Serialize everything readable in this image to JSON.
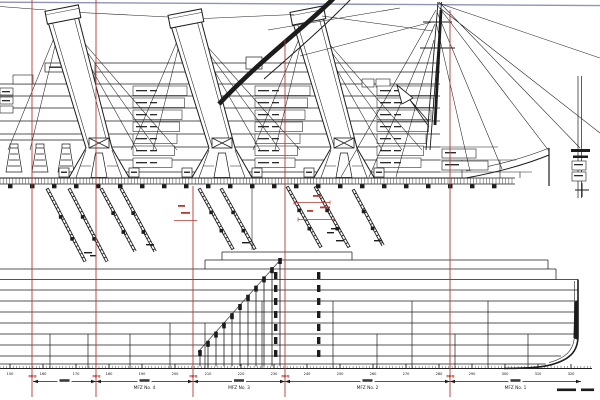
{
  "drawing": {
    "colors": {
      "ink": "#1c1c1c",
      "fire_line": "#b43a34",
      "mfb_text": "#c03a30",
      "top_line": "#9093b4",
      "background": "#ffffff"
    },
    "fire_zones": {
      "mfb_label": "MFB",
      "mfb_positions": [
        32,
        96,
        193,
        285,
        450
      ],
      "lines": [
        {
          "x": 32,
          "y1": 0
        },
        {
          "x": 96,
          "y1": 0
        },
        {
          "x": 193,
          "y1": 186
        },
        {
          "x": 285,
          "y1": 40
        },
        {
          "x": 450,
          "y1": 10
        }
      ],
      "zones": [
        {
          "x1": 33,
          "x2": 96,
          "label": ""
        },
        {
          "x1": 96,
          "x2": 193,
          "label": "MFZ No. 4"
        },
        {
          "x1": 193,
          "x2": 285,
          "label": "MFZ No. 3"
        },
        {
          "x1": 285,
          "x2": 450,
          "label": "MFZ No. 2"
        },
        {
          "x1": 450,
          "x2": 581,
          "label": "MFZ No. 1"
        }
      ]
    },
    "ruler": {
      "numbers": [
        "150",
        "160",
        "170",
        "180",
        "190",
        "200",
        "210",
        "220",
        "230",
        "240",
        "250",
        "260",
        "270",
        "280",
        "290",
        "300",
        "310",
        "320"
      ]
    }
  }
}
